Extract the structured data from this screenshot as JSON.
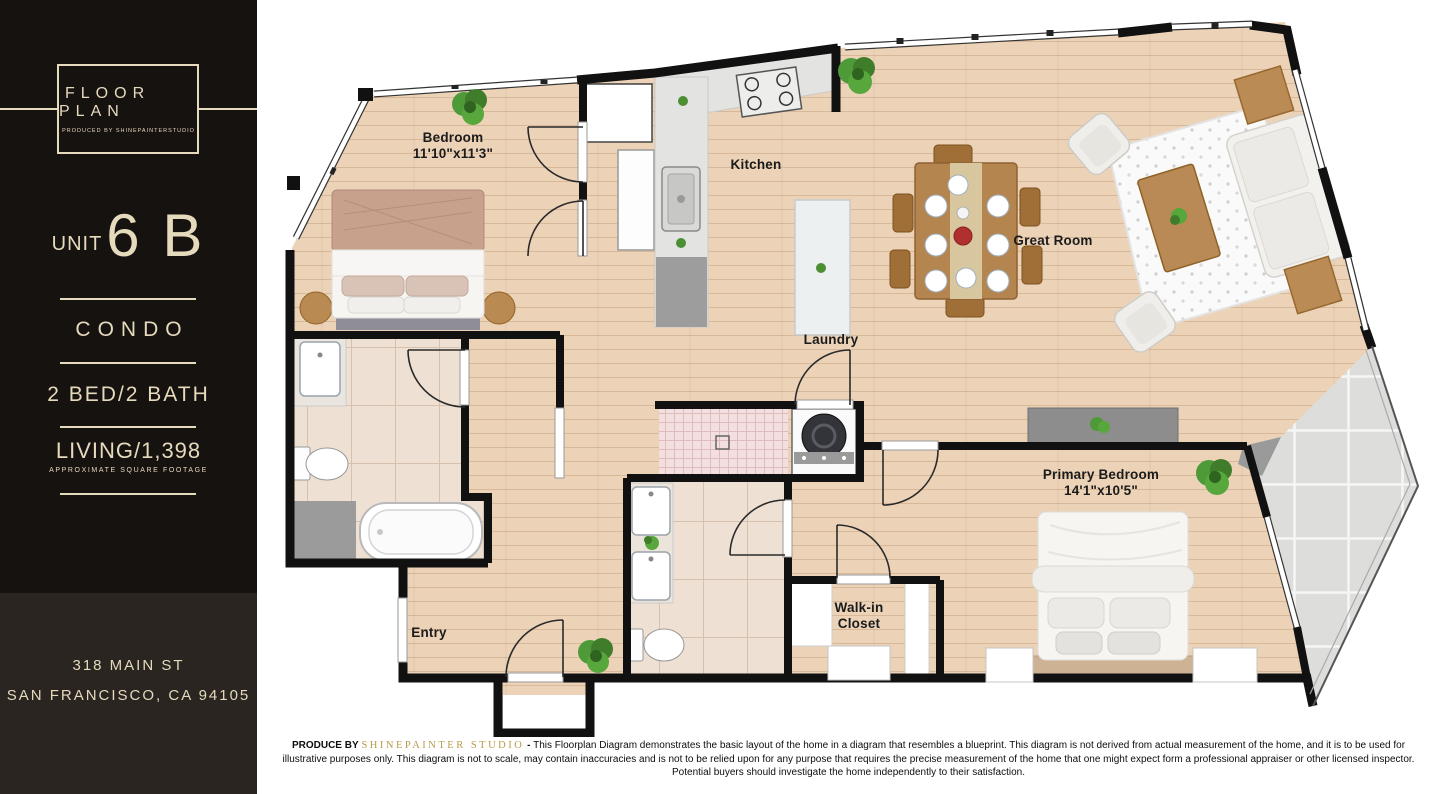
{
  "sidebar": {
    "brand_title": "FLOOR PLAN",
    "brand_subtitle": "PRODUCED BY SHINEPAINTERSTUDIO",
    "unit_label": "UNIT",
    "unit_number": "6 B",
    "property_type": "CONDO",
    "beds_baths": "2 BED/2 BATH",
    "living_area": "LIVING/1,398",
    "living_area_note": "APPROXIMATE SQUARE FOOTAGE",
    "address_line1": "318 MAIN ST",
    "address_line2": "SAN FRANCISCO, CA 94105"
  },
  "floorplan": {
    "rooms": [
      {
        "id": "bedroom",
        "label": "Bedroom",
        "dimensions": "11'10\"x11'3\""
      },
      {
        "id": "kitchen",
        "label": "Kitchen",
        "dimensions": ""
      },
      {
        "id": "great-room",
        "label": "Great Room",
        "dimensions": ""
      },
      {
        "id": "laundry",
        "label": "Laundry",
        "dimensions": ""
      },
      {
        "id": "primary-bedroom",
        "label": "Primary Bedroom",
        "dimensions": "14'1\"x10'5\""
      },
      {
        "id": "walk-in-closet",
        "label": "Walk-in Closet",
        "dimensions": ""
      },
      {
        "id": "entry",
        "label": "Entry",
        "dimensions": ""
      }
    ]
  },
  "footer": {
    "produce_by": "PRODUCE BY",
    "studio": "SHINEPAINTER STUDIO",
    "separator": "-",
    "disclaimer": "This Floorplan Diagram demonstrates the basic layout of the home in a diagram that resembles a blueprint. This diagram is not derived from actual measurement of the home, and it is to be used for illustrative purposes only. This diagram is not to scale, may contain inaccuracies and is not to be relied upon for any purpose that requires the precise measurement of the home that one might expect form a professional appraiser or other licensed inspector. Potential buyers should investigate the home independently to their satisfaction."
  },
  "colors": {
    "sidebar_background": "#161210",
    "sidebar_footer_background": "#2a2521",
    "brand_cream": "#e6dabd",
    "studio_gold": "#b79a4a",
    "wall_black": "#111111",
    "wood_floor": "#ecd3b8",
    "balcony_tile_gray": "#dddddb",
    "shower_pink": "#f3dfdf"
  }
}
